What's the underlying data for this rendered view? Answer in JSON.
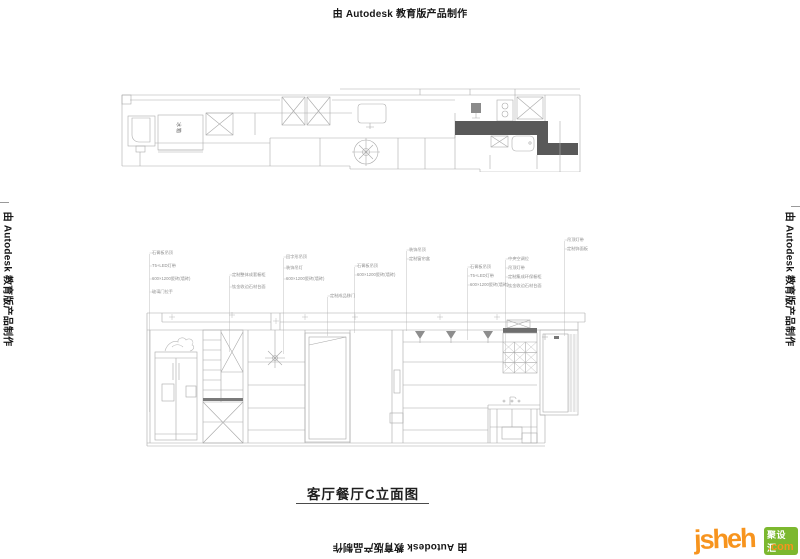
{
  "watermark": {
    "text": "由 Autodesk 教育版产品制作"
  },
  "plan": {
    "fridge_label": "冰箱"
  },
  "elevation": {
    "title": "客厅餐厅C立面图",
    "annotations": {
      "g1": [
        "石膏板吊顶",
        "T5+LED灯带",
        "600×1200瓷砖(墙砖)",
        "玻璃门拉手"
      ],
      "g2": [
        "定制整体成套橱柜",
        "钛金收边石材台面"
      ],
      "g3": [
        "回字形吊顶",
        "装饰吊灯",
        "600×1200瓷砖(墙砖)"
      ],
      "g4": [
        "定制成品移门"
      ],
      "g5": [
        "装饰吊顶",
        "定制窗帘盒"
      ],
      "g6": [
        "石膏板吊顶",
        "600×1200瓷砖(墙砖)"
      ],
      "g7": [
        "石膏板吊顶",
        "T5+LED灯带",
        "600×1200瓷砖(墙砖)"
      ],
      "g8": [
        "中央空调位",
        "吊顶灯带",
        "定制集成环保橱柜",
        "钛金收边石材台面"
      ],
      "g9": [
        "吊顶灯带",
        "定制饰面板"
      ]
    }
  },
  "logo": {
    "brand": "jsheh",
    "tld": ".com",
    "badge": "聚设汇"
  },
  "colors": {
    "line": "#aaaaaa",
    "dark_fill": "#595959",
    "logo_orange": "#f7941e",
    "logo_green": "#7cb82f"
  }
}
